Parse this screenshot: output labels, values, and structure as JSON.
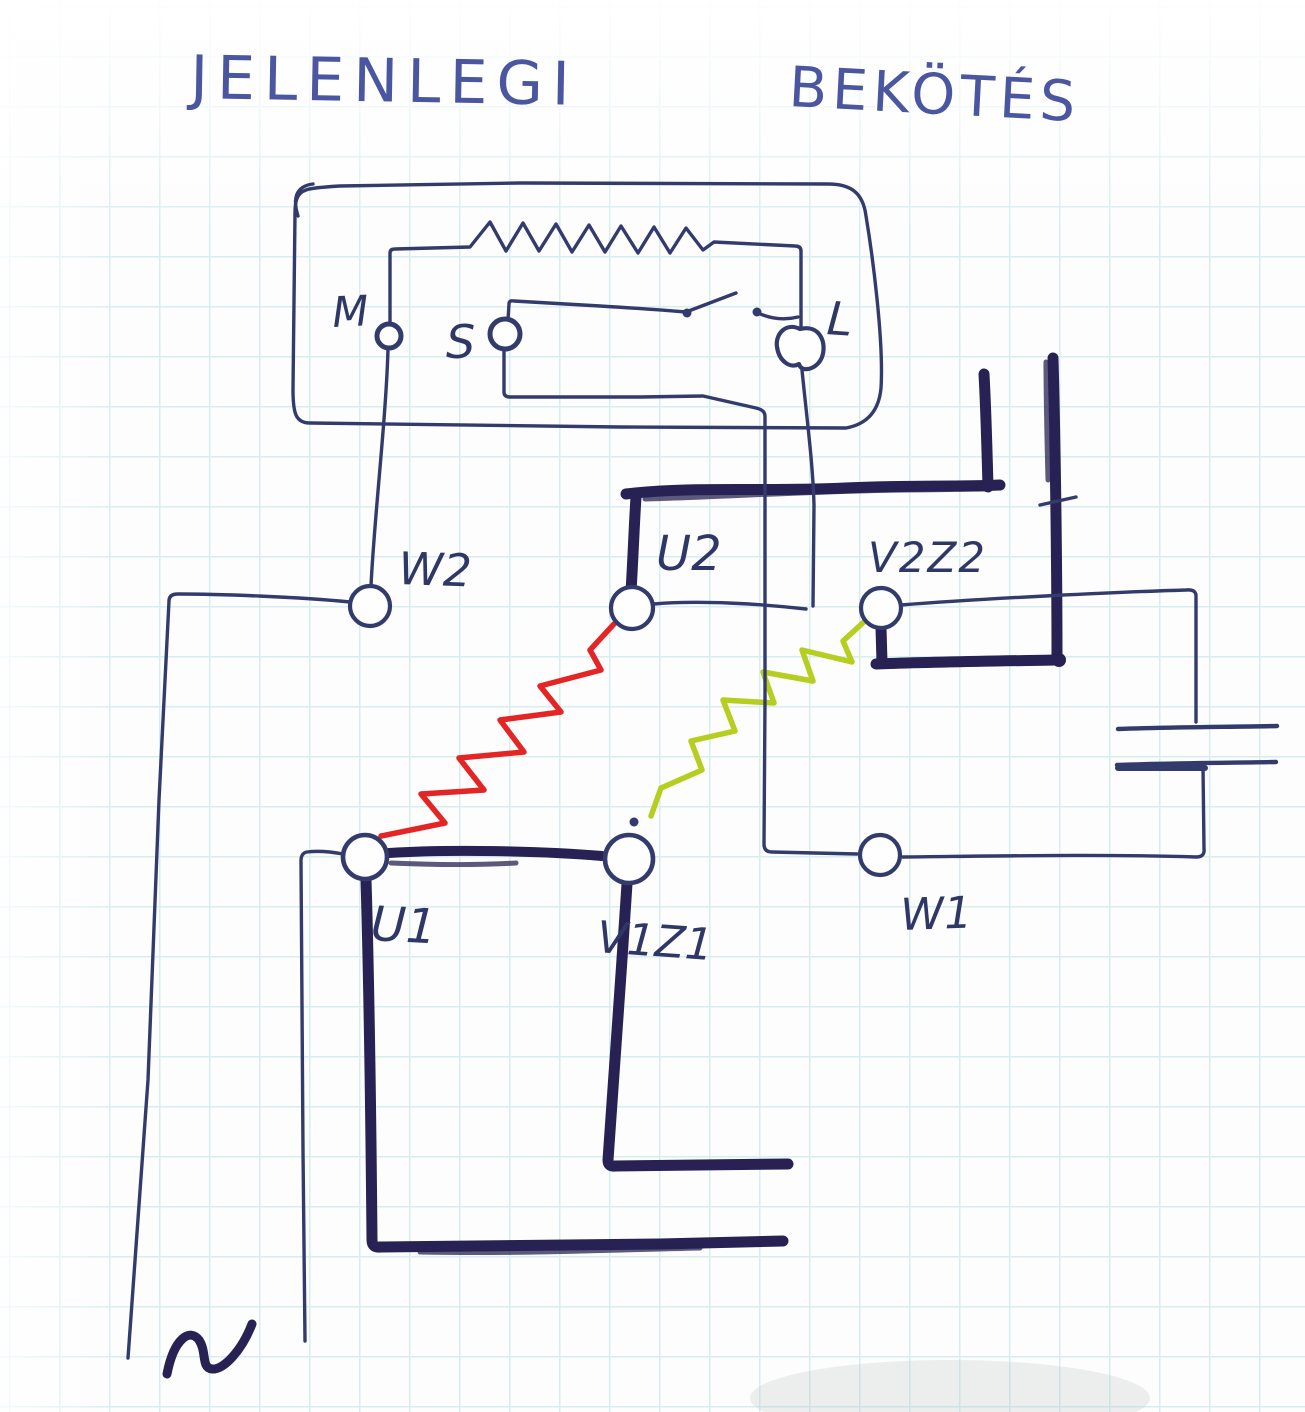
{
  "title": {
    "word1": "JELENLEGI",
    "word2": "BEKÖTÉS"
  },
  "switch_box": {
    "terminal_m": "M",
    "terminal_s": "S",
    "terminal_l": "L"
  },
  "motor_terminals": {
    "w2": "W2",
    "u2": "U2",
    "v2z2": "V2Z2",
    "u1": "U1",
    "v1z1": "V1Z1",
    "w1": "W1"
  },
  "symbols": {
    "resistor": "resistor-zigzag",
    "switch": "open-switch-contacts",
    "capacitor": "capacitor-plates",
    "ac_source": "ac-tilde",
    "main_winding": "red-winding-zigzag",
    "aux_winding": "green-winding-zigzag"
  },
  "colors": {
    "ink": "#333b6d",
    "marker": "#272253",
    "main_winding": "#e32525",
    "aux_winding": "#b5ce20",
    "paper": "#fcfdfc",
    "grid": "#d8edf0",
    "title_ink": "#4a56a0"
  }
}
